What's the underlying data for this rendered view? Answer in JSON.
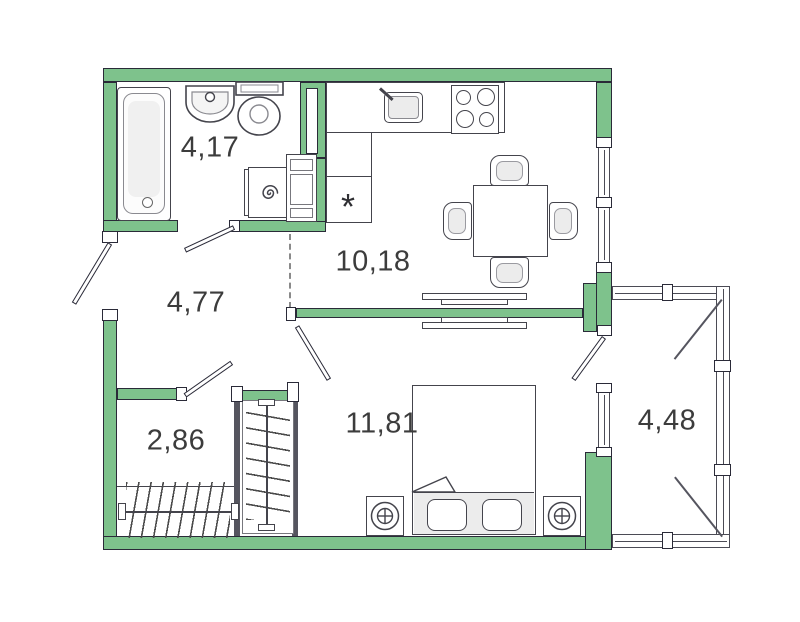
{
  "plan": {
    "rooms": [
      {
        "id": "bathroom",
        "area_label": "4,17"
      },
      {
        "id": "hallway",
        "area_label": "4,77"
      },
      {
        "id": "kitchen_living",
        "area_label": "10,18"
      },
      {
        "id": "wardrobe",
        "area_label": "2,86"
      },
      {
        "id": "bedroom",
        "area_label": "11,81"
      },
      {
        "id": "balcony",
        "area_label": "4,48"
      }
    ],
    "marks": {
      "kitchen_unit_asterisk": "*"
    },
    "colors": {
      "wall_fill": "#7ec28c",
      "outline": "#2a2a38",
      "furniture_line": "#44444c",
      "light_fill": "#ececec"
    }
  }
}
